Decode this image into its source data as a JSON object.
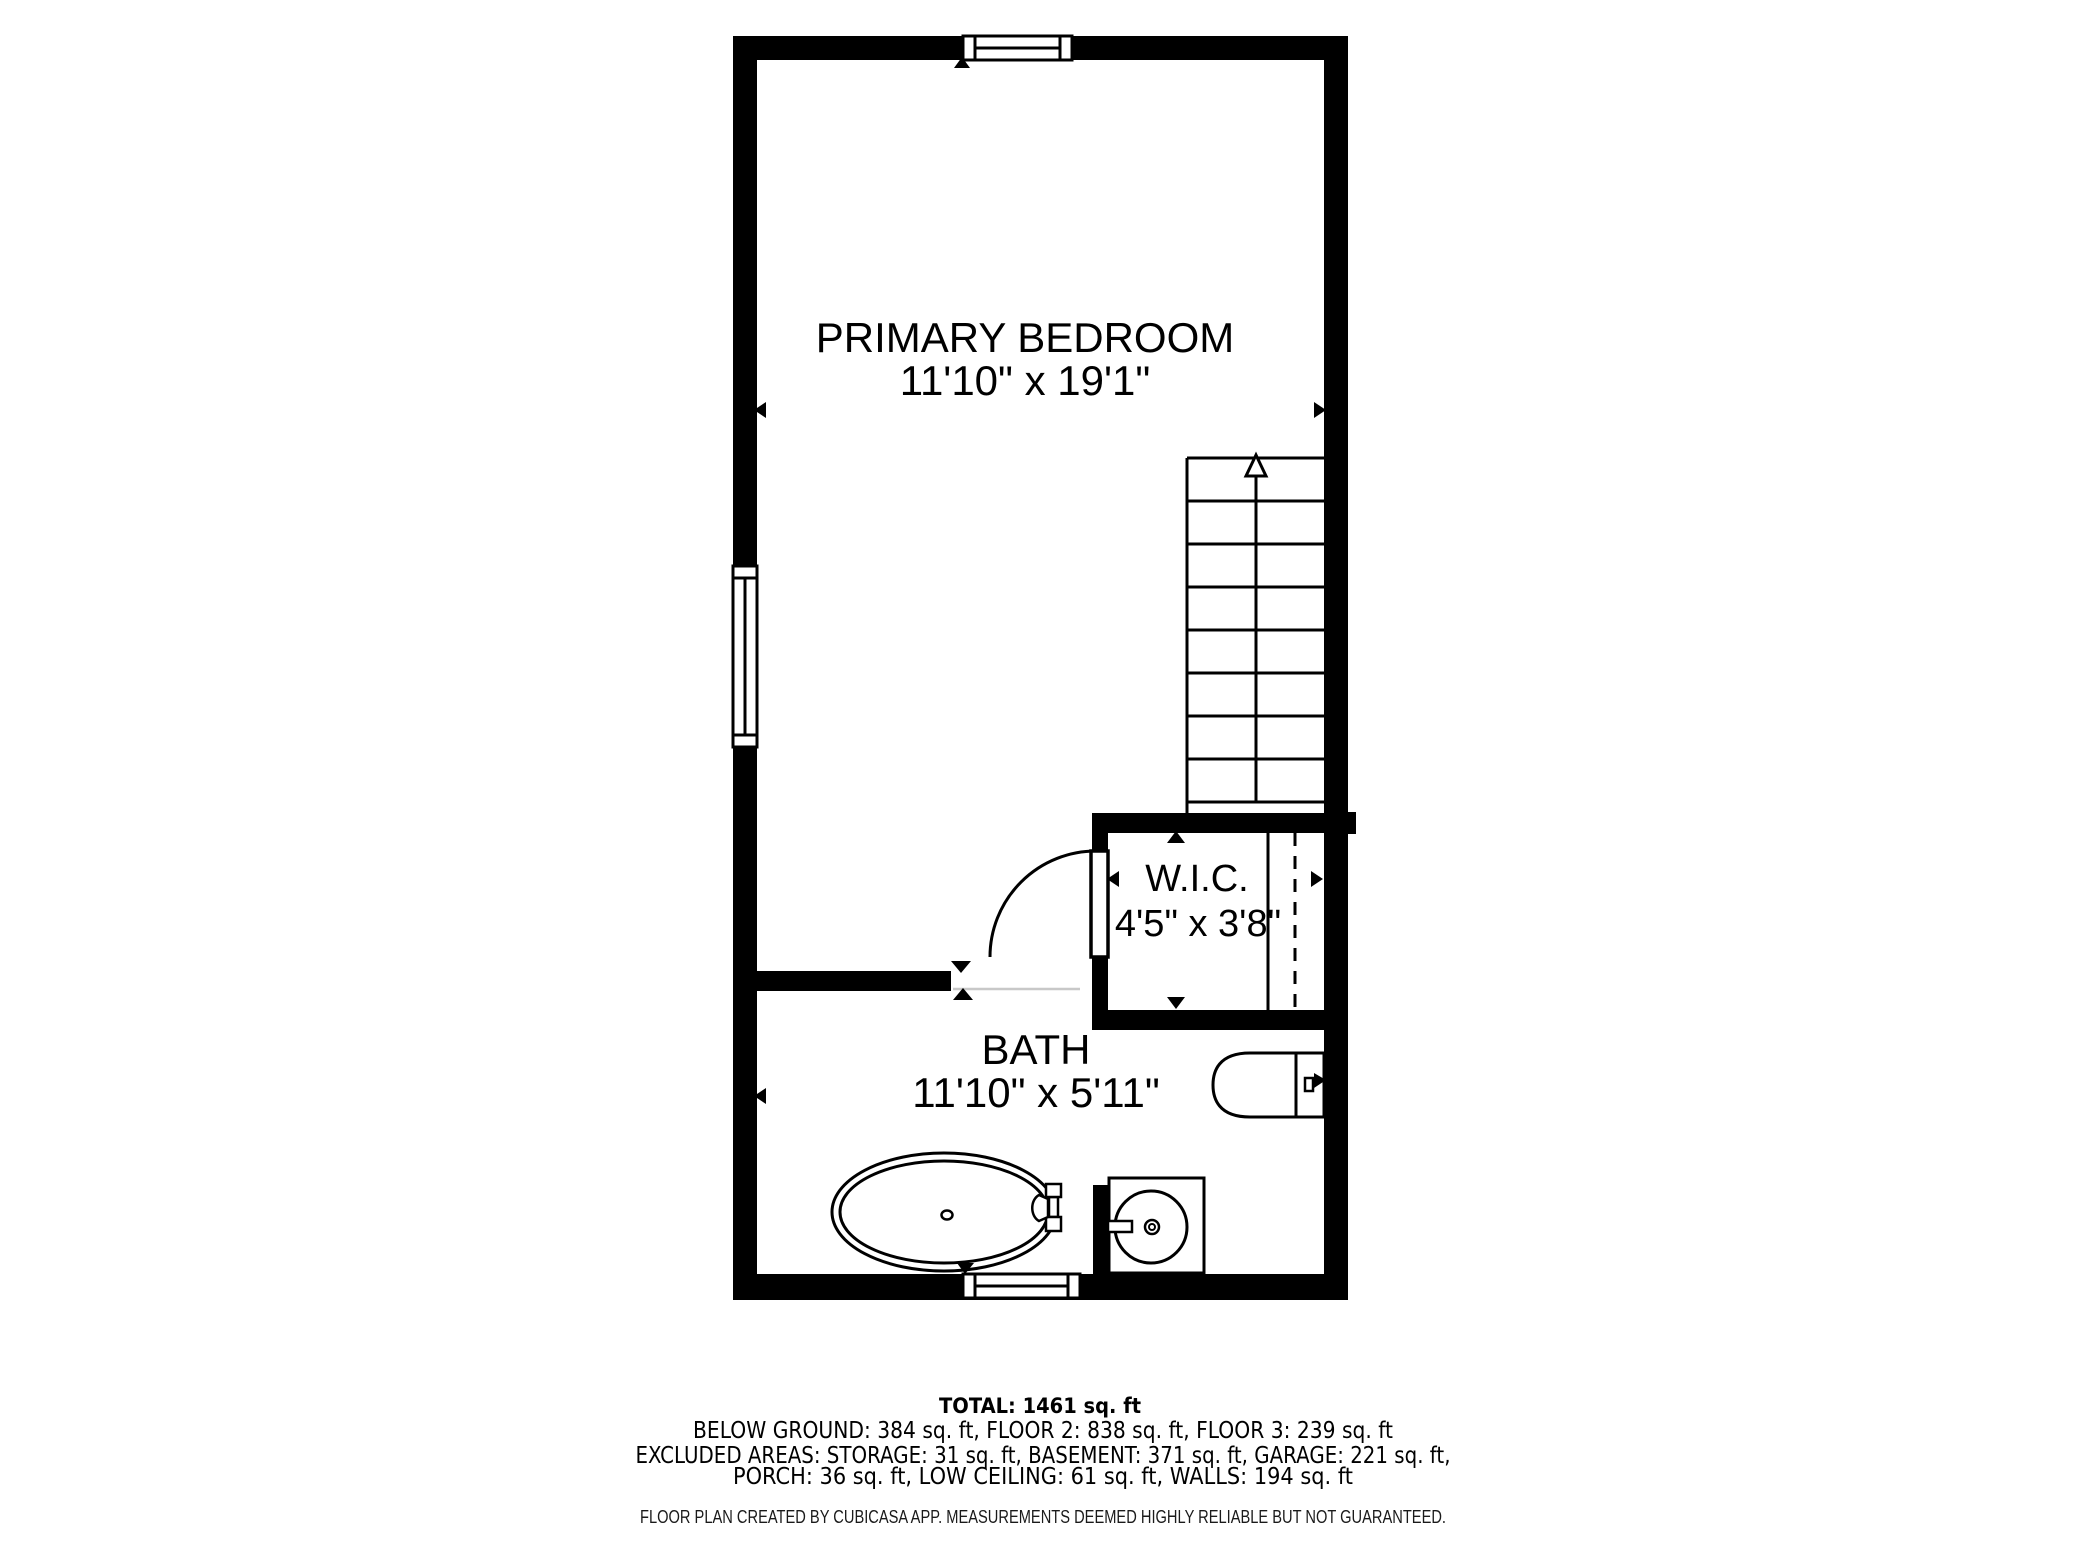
{
  "plan": {
    "rooms": [
      {
        "name": "PRIMARY BEDROOM",
        "dims": "11'10\" x 19'1\""
      },
      {
        "name": "W.I.C.",
        "dims": "4'5\" x 3'8\""
      },
      {
        "name": "BATH",
        "dims": "11'10\" x 5'11\""
      }
    ],
    "fixtures": [
      "stairs-icon",
      "door-swing-icon",
      "toilet-icon",
      "bathtub-icon",
      "sink-vanity-icon",
      "window-icon"
    ]
  },
  "summary": {
    "total": "TOTAL: 1461 sq. ft",
    "floors": "BELOW GROUND: 384 sq. ft, FLOOR 2: 838 sq. ft, FLOOR 3: 239 sq. ft",
    "excluded1": "EXCLUDED AREAS: STORAGE: 31 sq. ft, BASEMENT: 371 sq. ft, GARAGE: 221 sq. ft,",
    "excluded2": "PORCH: 36 sq. ft, LOW CEILING: 61 sq. ft, WALLS: 194 sq. ft",
    "disclaimer": "FLOOR PLAN CREATED BY CUBICASA APP. MEASUREMENTS DEEMED HIGHLY RELIABLE BUT NOT GUARANTEED."
  },
  "colors": {
    "wall": "#000000",
    "background": "#ffffff",
    "opening_line": "#c8c8c8"
  }
}
